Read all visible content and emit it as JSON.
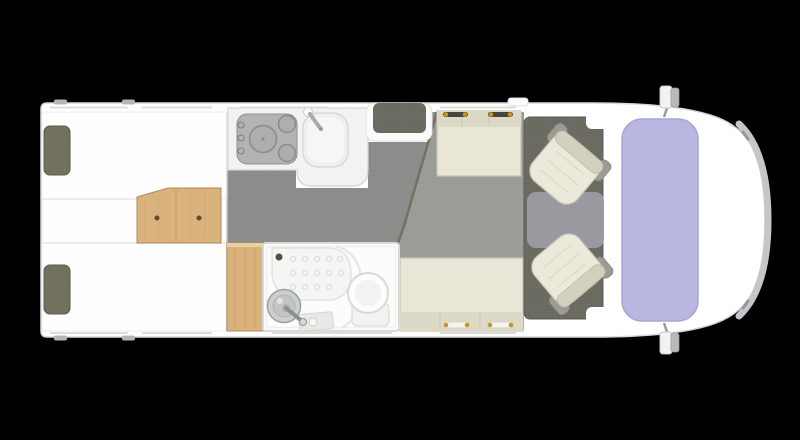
{
  "scene": {
    "type": "motorhome-floorplan-top-view",
    "orientation": "front-of-vehicle-right"
  },
  "palette": {
    "background": "#000000",
    "body": "#ffffff",
    "outline": "#d8d8da",
    "bumper": "#c6c6ca",
    "mirror_gray": "#b9b9bd",
    "windshield": "#b8b6e1",
    "windshield_edge": "#a8a6d6",
    "floor_dark": "#8c8c8a",
    "floor_light": "#9b9b97",
    "seam": "#72725f",
    "cab_mat": "#6d6d63",
    "console": "#9a99a0",
    "wood": "#d9b27e",
    "wood_dark": "#b3895a",
    "wood_light": "#ecd0a2",
    "bench": "#e9e6d8",
    "bench_back": "#dcd9c7",
    "seat": "#ece9db",
    "seat_back": "#d3d0c0",
    "armrest": "#9c9c94",
    "pillow": "#73735f",
    "counter": "#f3f3f1",
    "hob": "#b3b4b2",
    "steel": "#8a8c8a",
    "fixture_white": "#fbfbfb",
    "basin": "#cccfcc",
    "belt_dot": "#c9951f",
    "headrest_dark": "#45453d",
    "wall_line": "#dcdcde",
    "bed_line": "#dcdcda"
  },
  "components": {
    "vehicle": "Motorhome body",
    "bumper": "Front bumper",
    "mirror_top": "Side mirror (driver)",
    "mirror_bottom": "Side mirror (passenger)",
    "windshield": "Cab windshield",
    "bedroom": "Rear bedroom with twin beds",
    "bed_top": "Twin bed (top)",
    "bed_bottom": "Twin bed (bottom)",
    "pillow_top": "Pillow",
    "pillow_bottom": "Pillow",
    "step": "Bed step unit with drawers",
    "kitchen": "Kitchen counter",
    "hob": "Gas hob (3 burners)",
    "sink": "Kitchen sink with tap",
    "entry_mat": "Entrance door step mat",
    "floor_kitchen": "Kitchen / corridor floor",
    "floor_lounge": "Lounge floor",
    "bench_top": "Travel bench seat (top)",
    "bench_bottom": "Lounge bench seat (bottom)",
    "cab_mat": "Cab floor mat",
    "console": "Cab centre floor panel",
    "cab_seat_top": "Swivel cab seat (top)",
    "cab_seat_bottom": "Swivel cab seat (bottom)",
    "wardrobe": "Wardrobe",
    "bathroom": "Bathroom",
    "shower": "Shower tray",
    "basin": "Washbasin with tap",
    "washstand": "Washstand counter",
    "toilet": "Toilet"
  }
}
